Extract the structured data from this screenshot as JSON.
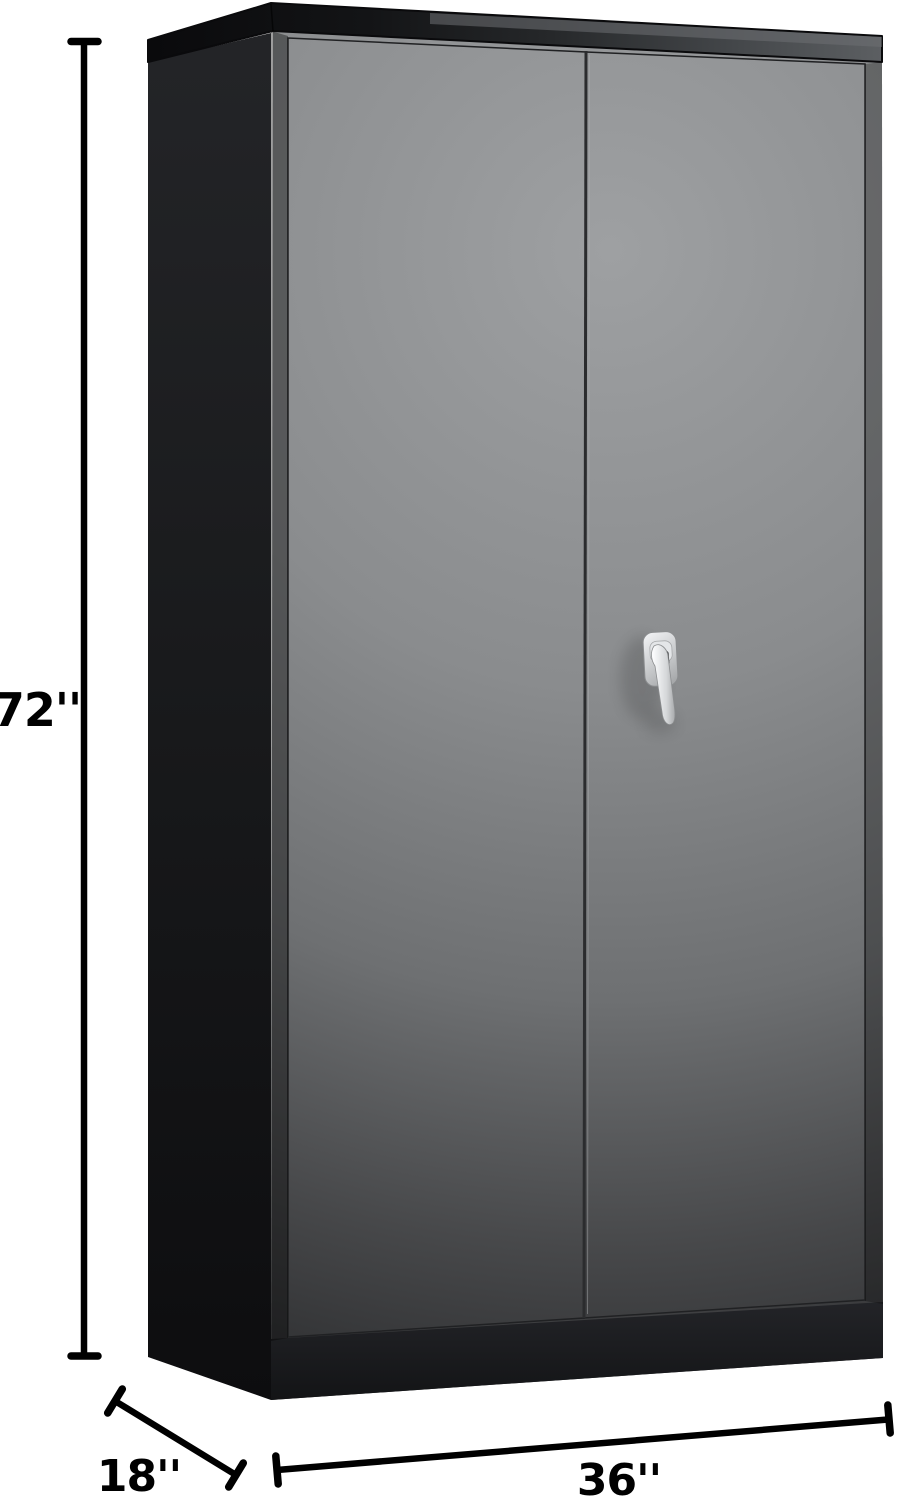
{
  "image": {
    "kind": "product-dimension-diagram",
    "subject": "Tall black steel storage cabinet with two doors and a silver locking lever handle",
    "background_color": "#ffffff"
  },
  "annotations": {
    "height": {
      "label": "72''",
      "inches": 72,
      "placement": "vertical line, left of cabinet"
    },
    "depth": {
      "label": "18''",
      "inches": 18,
      "placement": "diagonal line, bottom left"
    },
    "width": {
      "label": "36''",
      "inches": 36,
      "placement": "horizontal line, bottom"
    }
  },
  "cabinet": {
    "doors": 2,
    "handle": {
      "type": "lever lock with keyhole",
      "finish": "polished silver"
    }
  },
  "colors": {
    "annotation_ink": "#000000",
    "front_highlight": "#9ea0a2",
    "front_shadow": "#242527",
    "side_panel": "#1a1b1d",
    "lid_dark": "#0a0a0c",
    "lid_light": "#5c5f62",
    "handle_silver_light": "#f4f5f7",
    "handle_silver_dark": "#97999b"
  }
}
